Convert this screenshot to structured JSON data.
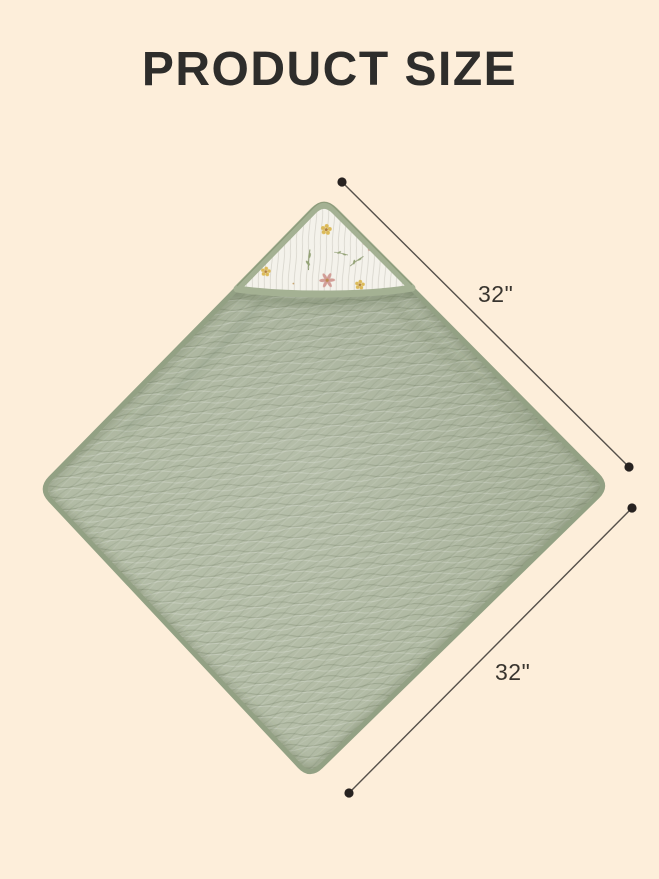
{
  "header": {
    "title": "PRODUCT SIZE"
  },
  "dimensions": {
    "line_color": "#55504a",
    "dot_color": "#272220",
    "labels": [
      {
        "id": "top-right-edge",
        "label": "32\""
      },
      {
        "id": "bottom-right-edge",
        "label": "32\""
      }
    ]
  },
  "colors": {
    "background": "#fdeeda",
    "title_text": "#2e2d2b",
    "blanket_green": "#a9b39b",
    "blanket_green_light": "#b6bfa9",
    "blanket_edge_piping": "#93a184",
    "hood_fabric": "#f4f2eb",
    "hood_binding": "#a4b193",
    "flower_pink": "#d29d96",
    "flower_yellow": "#dcba58",
    "stem_green": "#87966b"
  },
  "graphic": {
    "subject": "hooded-muslin-baby-towel-diamond-view"
  }
}
